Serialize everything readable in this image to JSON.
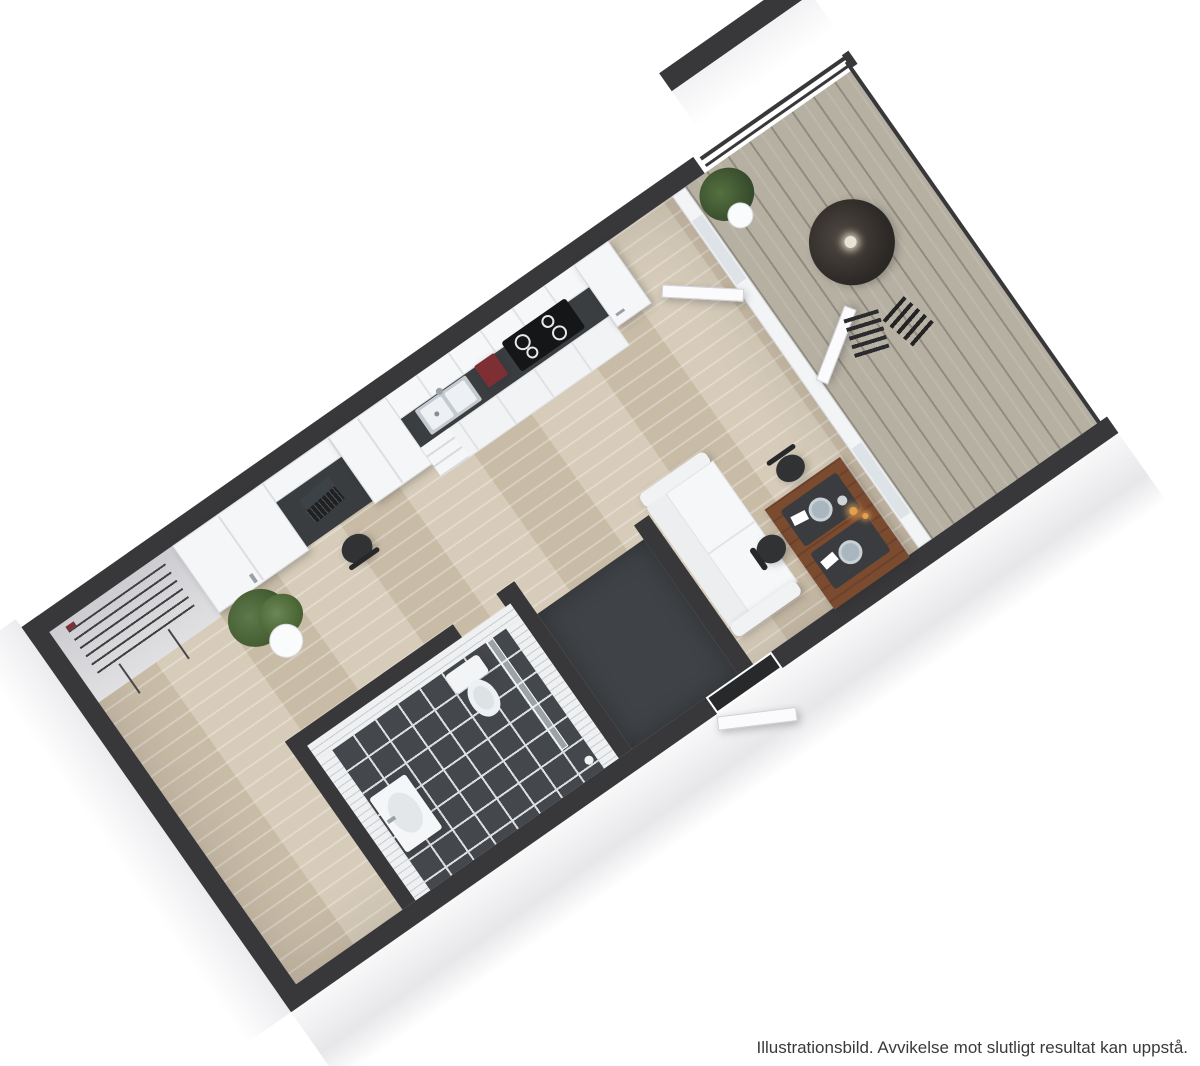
{
  "caption": {
    "text": "Illustrationsbild. Avvikelse mot slutligt resultat kan uppstå."
  },
  "colors": {
    "wall-top": "#38383a",
    "wall-face": "#d3d3d7",
    "exterior": "#f6f6f8",
    "wood": "#d2c6b1",
    "deck": "#b6b0a2",
    "bathfloor": "#44474b",
    "grout": "#dcdfe1",
    "tile": "#eef0f2",
    "tileline": "#c7ccd0",
    "counter": "#3b3e41",
    "cooktop": "#141618",
    "cabinet": "#f5f6f8",
    "cabedge": "#dcdee1",
    "tablewood": "#7b4b30",
    "black": "#303234",
    "green": "#4e6b3f",
    "greendark": "#35492b",
    "red": "#7e2f33",
    "plate": "#a9b6bf",
    "entry": "#3f4246",
    "threshold": "#27292b",
    "caption": "#3a3a3a"
  },
  "scene": {
    "type": "3d-floor-plan-render",
    "view": "rotated top-down isometric",
    "rotation_deg": -35,
    "rooms": [
      "kitchen",
      "living-dining",
      "bathroom",
      "entry-hall",
      "balcony",
      "wardrobe-desk-nook"
    ],
    "objects": [
      "kitchen-cabinets",
      "kitchen-sink",
      "cooktop",
      "coffee-maker",
      "tall-cabinet-fridge",
      "dining-table",
      "wishbone-chairs",
      "plates",
      "napkins",
      "candles",
      "sofa",
      "entrance-door",
      "door-threshold",
      "toilet",
      "bathroom-sink",
      "shower-glass",
      "wall-tiles",
      "floor-tiles",
      "wardrobes",
      "built-in-desk",
      "laptop",
      "desk-chair",
      "potted-plant",
      "radiator",
      "balcony-bistro-table",
      "balcony-folding-chairs",
      "balcony-plant",
      "railing",
      "wood-floor",
      "deck-planks",
      "neighbor-wall"
    ]
  }
}
